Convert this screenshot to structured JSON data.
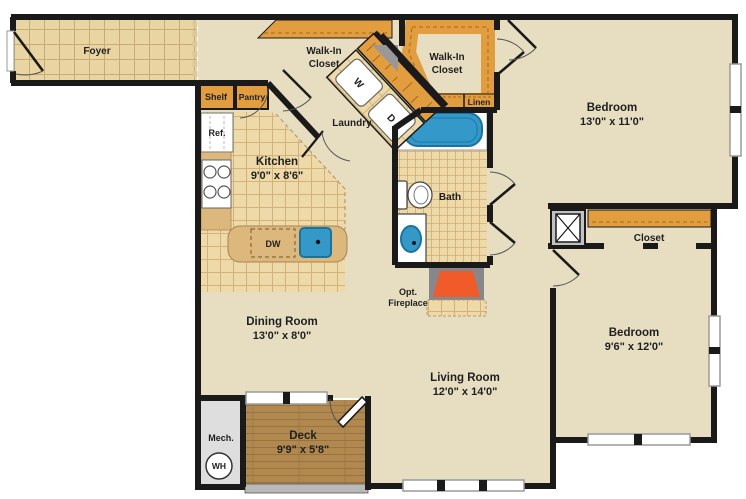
{
  "plan": {
    "type": "apartment-floor-plan",
    "colors": {
      "wall": "#1a1a1a",
      "floor_beige": "#e7dec2",
      "tile_tan": "#e9d5a2",
      "closet_orange": "#e29d3f",
      "counter_tan": "#dcb87c",
      "deck_wood": "#b1894f",
      "mech_gray": "#dedede",
      "fixture_blue": "#3498c9",
      "fireplace_orange": "#f15a29",
      "fireplace_gray": "#87878b"
    },
    "rooms": {
      "foyer": {
        "name": "Foyer"
      },
      "walk_in_closet_1": {
        "name_line1": "Walk-In",
        "name_line2": "Closet"
      },
      "walk_in_closet_2": {
        "name_line1": "Walk-In",
        "name_line2": "Closet"
      },
      "laundry": {
        "name": "Laundry"
      },
      "kitchen": {
        "name": "Kitchen",
        "dims": "9'0\" x 8'6\""
      },
      "bath": {
        "name": "Bath"
      },
      "bedroom_1": {
        "name": "Bedroom",
        "dims": "13'0\" x 11'0\""
      },
      "closet": {
        "name": "Closet"
      },
      "bedroom_2": {
        "name": "Bedroom",
        "dims": "9'6\" x 12'0\""
      },
      "dining_room": {
        "name": "Dining Room",
        "dims": "13'0\" x 8'0\""
      },
      "living_room": {
        "name": "Living Room",
        "dims": "12'0\" x 14'0\""
      },
      "deck": {
        "name": "Deck",
        "dims": "9'9\" x 5'8\""
      },
      "mech": {
        "name": "Mech."
      }
    },
    "fixtures": {
      "shelf": "Shelf",
      "pantry": "Pantry",
      "refrigerator": "Ref.",
      "washer": "W",
      "dryer": "D",
      "dishwasher": "DW",
      "linen": "Linen",
      "water_heater": "WH",
      "fireplace_line1": "Opt.",
      "fireplace_line2": "Fireplace"
    }
  }
}
